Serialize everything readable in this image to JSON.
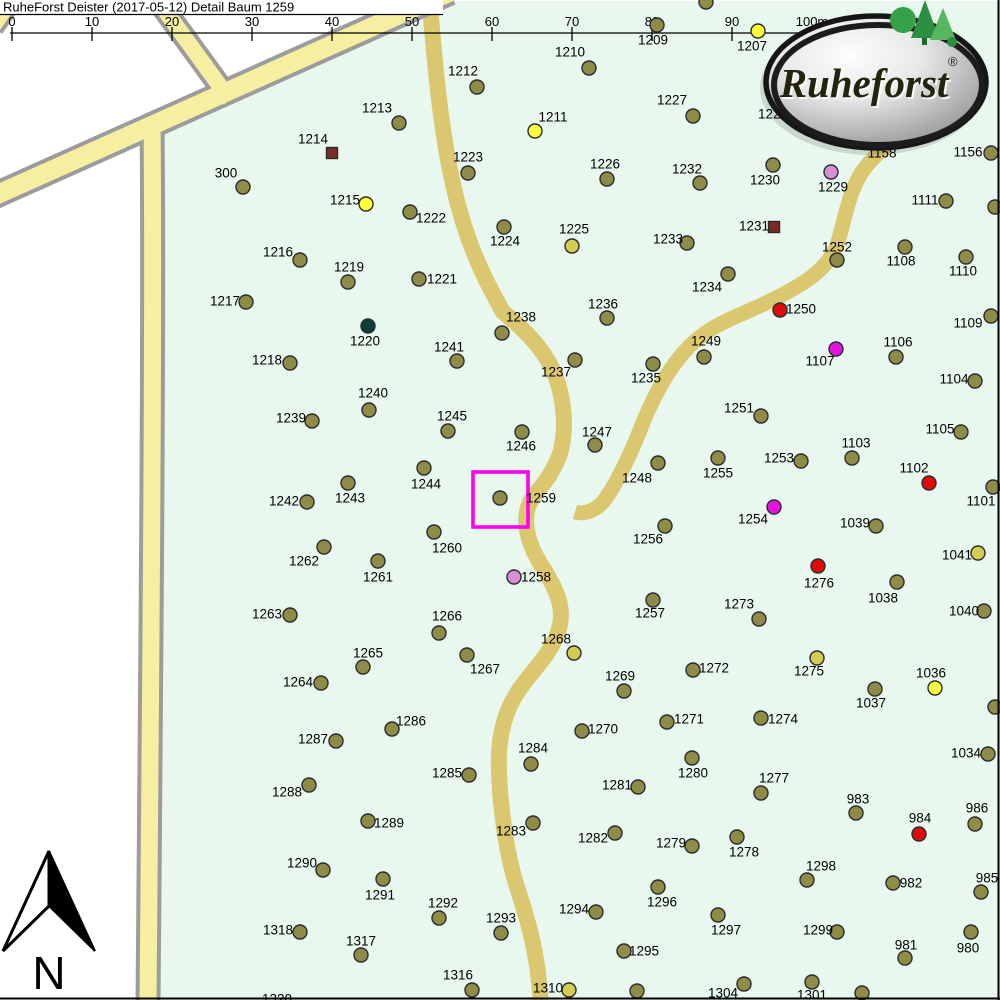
{
  "title": "RuheForst Deister (2017-05-12) Detail  Baum 1259",
  "scale_bar": {
    "labels": [
      "0",
      "10",
      "20",
      "30",
      "40",
      "50",
      "60",
      "70",
      "80",
      "90",
      "100m"
    ]
  },
  "north_label": "N",
  "logo": {
    "text": "Ruheforst",
    "reg": "®"
  },
  "highlight": {
    "tree_id": "1259",
    "x": 473,
    "y": 472,
    "size": 55,
    "color": "#FF00F2"
  },
  "colors": {
    "olive": "#8F8C48",
    "yellow": "#FFFF3C",
    "ygreen": "#D4CC52",
    "red": "#DE0D0D",
    "magenta": "#E513DF",
    "orchid": "#D98FD5",
    "teal": "#0F3D3B",
    "brown": "#7E2B26",
    "road_yellow": "#F6EFA2",
    "road_casing": "#9C9C9C",
    "road_tan": "#DCC771",
    "forest_green": "#E8F8EE"
  },
  "map": {
    "trees": [
      {
        "id": "300",
        "x": 243,
        "y": 187,
        "lx": 226,
        "ly": 173
      },
      {
        "id": "1207",
        "x": 758,
        "y": 31,
        "lx": 752,
        "ly": 46,
        "c": "yellow"
      },
      {
        "id": "1209",
        "x": 657,
        "y": 25,
        "lx": 653,
        "ly": 40
      },
      {
        "id": "",
        "x": 706,
        "y": 2
      },
      {
        "id": "1210",
        "x": 589,
        "y": 68,
        "lx": 570,
        "ly": 52
      },
      {
        "id": "1211",
        "x": 535,
        "y": 131,
        "lx": 553,
        "ly": 117,
        "c": "yellow"
      },
      {
        "id": "1212",
        "x": 477,
        "y": 87,
        "lx": 463,
        "ly": 71
      },
      {
        "id": "1213",
        "x": 399,
        "y": 123,
        "lx": 377,
        "ly": 108
      },
      {
        "id": "1214",
        "x": 332,
        "y": 153,
        "lx": 313,
        "ly": 139,
        "c": "brown",
        "shape": "sq"
      },
      {
        "id": "1215",
        "x": 366,
        "y": 204,
        "lx": 345,
        "ly": 200,
        "c": "yellow"
      },
      {
        "id": "1216",
        "x": 300,
        "y": 260,
        "lx": 278,
        "ly": 252
      },
      {
        "id": "1217",
        "x": 246,
        "y": 302,
        "lx": 225,
        "ly": 301
      },
      {
        "id": "1218",
        "x": 290,
        "y": 363,
        "lx": 267,
        "ly": 360
      },
      {
        "id": "1219",
        "x": 348,
        "y": 282,
        "lx": 349,
        "ly": 267
      },
      {
        "id": "1220",
        "x": 368,
        "y": 326,
        "lx": 365,
        "ly": 341,
        "c": "teal"
      },
      {
        "id": "1221",
        "x": 419,
        "y": 279,
        "lx": 442,
        "ly": 279
      },
      {
        "id": "1222",
        "x": 410,
        "y": 212,
        "lx": 431,
        "ly": 218
      },
      {
        "id": "1223",
        "x": 468,
        "y": 173,
        "lx": 468,
        "ly": 157
      },
      {
        "id": "1224",
        "x": 504,
        "y": 227,
        "lx": 505,
        "ly": 241
      },
      {
        "id": "1225",
        "x": 572,
        "y": 246,
        "lx": 574,
        "ly": 229,
        "c": "ygreen"
      },
      {
        "id": "1226",
        "x": 607,
        "y": 179,
        "lx": 605,
        "ly": 164
      },
      {
        "id": "1227",
        "x": 693,
        "y": 116,
        "lx": 672,
        "ly": 100
      },
      {
        "id": "1228",
        "lx": 773,
        "ly": 114
      },
      {
        "id": "1229",
        "x": 831,
        "y": 172,
        "lx": 833,
        "ly": 187,
        "c": "orchid"
      },
      {
        "id": "1230",
        "x": 773,
        "y": 165,
        "lx": 765,
        "ly": 180
      },
      {
        "id": "1231",
        "x": 774,
        "y": 227,
        "lx": 754,
        "ly": 226,
        "c": "brown",
        "shape": "sq"
      },
      {
        "id": "1232",
        "x": 700,
        "y": 183,
        "lx": 687,
        "ly": 169
      },
      {
        "id": "1233",
        "x": 687,
        "y": 243,
        "lx": 668,
        "ly": 239
      },
      {
        "id": "1234",
        "x": 728,
        "y": 274,
        "lx": 707,
        "ly": 287
      },
      {
        "id": "1235",
        "x": 653,
        "y": 364,
        "lx": 646,
        "ly": 378
      },
      {
        "id": "1236",
        "x": 607,
        "y": 318,
        "lx": 603,
        "ly": 304
      },
      {
        "id": "1237",
        "x": 575,
        "y": 360,
        "lx": 556,
        "ly": 372
      },
      {
        "id": "1238",
        "x": 502,
        "y": 333,
        "lx": 521,
        "ly": 317
      },
      {
        "id": "1239",
        "x": 312,
        "y": 421,
        "lx": 291,
        "ly": 418
      },
      {
        "id": "1240",
        "x": 369,
        "y": 410,
        "lx": 373,
        "ly": 393
      },
      {
        "id": "1241",
        "x": 457,
        "y": 361,
        "lx": 449,
        "ly": 347
      },
      {
        "id": "1242",
        "x": 307,
        "y": 502,
        "lx": 284,
        "ly": 501
      },
      {
        "id": "1243",
        "x": 348,
        "y": 483,
        "lx": 350,
        "ly": 498
      },
      {
        "id": "1244",
        "x": 424,
        "y": 468,
        "lx": 426,
        "ly": 484
      },
      {
        "id": "1245",
        "x": 448,
        "y": 431,
        "lx": 452,
        "ly": 416
      },
      {
        "id": "1246",
        "x": 522,
        "y": 432,
        "lx": 521,
        "ly": 446
      },
      {
        "id": "1247",
        "x": 595,
        "y": 445,
        "lx": 597,
        "ly": 432
      },
      {
        "id": "1248",
        "x": 658,
        "y": 463,
        "lx": 637,
        "ly": 478
      },
      {
        "id": "1249",
        "x": 704,
        "y": 357,
        "lx": 706,
        "ly": 341
      },
      {
        "id": "1250",
        "x": 780,
        "y": 310,
        "lx": 801,
        "ly": 309,
        "c": "red"
      },
      {
        "id": "1251",
        "x": 761,
        "y": 416,
        "lx": 739,
        "ly": 408
      },
      {
        "id": "1252",
        "x": 837,
        "y": 260,
        "lx": 837,
        "ly": 247
      },
      {
        "id": "1253",
        "x": 801,
        "y": 461,
        "lx": 779,
        "ly": 458
      },
      {
        "id": "1254",
        "x": 774,
        "y": 507,
        "lx": 753,
        "ly": 519,
        "c": "magenta"
      },
      {
        "id": "1255",
        "x": 718,
        "y": 458,
        "lx": 718,
        "ly": 473
      },
      {
        "id": "1256",
        "x": 665,
        "y": 526,
        "lx": 648,
        "ly": 539
      },
      {
        "id": "1257",
        "x": 653,
        "y": 600,
        "lx": 650,
        "ly": 613
      },
      {
        "id": "1258",
        "x": 514,
        "y": 577,
        "lx": 536,
        "ly": 577,
        "c": "orchid"
      },
      {
        "id": "1259",
        "x": 500,
        "y": 498,
        "lx": 541,
        "ly": 498
      },
      {
        "id": "1260",
        "x": 434,
        "y": 532,
        "lx": 447,
        "ly": 548
      },
      {
        "id": "1261",
        "x": 378,
        "y": 561,
        "lx": 378,
        "ly": 577
      },
      {
        "id": "1262",
        "x": 324,
        "y": 547,
        "lx": 304,
        "ly": 561
      },
      {
        "id": "1263",
        "x": 290,
        "y": 615,
        "lx": 267,
        "ly": 614
      },
      {
        "id": "1264",
        "x": 321,
        "y": 683,
        "lx": 298,
        "ly": 682
      },
      {
        "id": "1265",
        "x": 363,
        "y": 667,
        "lx": 368,
        "ly": 653
      },
      {
        "id": "1266",
        "x": 439,
        "y": 633,
        "lx": 447,
        "ly": 616
      },
      {
        "id": "1267",
        "x": 467,
        "y": 655,
        "lx": 485,
        "ly": 669
      },
      {
        "id": "1268",
        "x": 574,
        "y": 653,
        "lx": 556,
        "ly": 639,
        "c": "ygreen"
      },
      {
        "id": "1269",
        "x": 624,
        "y": 691,
        "lx": 620,
        "ly": 676
      },
      {
        "id": "1270",
        "x": 582,
        "y": 731,
        "lx": 603,
        "ly": 729
      },
      {
        "id": "1271",
        "x": 667,
        "y": 722,
        "lx": 689,
        "ly": 719
      },
      {
        "id": "1272",
        "x": 693,
        "y": 670,
        "lx": 714,
        "ly": 668
      },
      {
        "id": "1273",
        "x": 759,
        "y": 619,
        "lx": 739,
        "ly": 604
      },
      {
        "id": "1274",
        "x": 761,
        "y": 718,
        "lx": 783,
        "ly": 719
      },
      {
        "id": "1275",
        "x": 817,
        "y": 658,
        "lx": 809,
        "ly": 671,
        "c": "ygreen"
      },
      {
        "id": "1276",
        "x": 818,
        "y": 566,
        "lx": 819,
        "ly": 583,
        "c": "red"
      },
      {
        "id": "1277",
        "x": 761,
        "y": 793,
        "lx": 774,
        "ly": 778
      },
      {
        "id": "1278",
        "x": 737,
        "y": 837,
        "lx": 744,
        "ly": 852
      },
      {
        "id": "1279",
        "x": 692,
        "y": 846,
        "lx": 671,
        "ly": 843
      },
      {
        "id": "1280",
        "x": 692,
        "y": 758,
        "lx": 693,
        "ly": 773
      },
      {
        "id": "1281",
        "x": 638,
        "y": 787,
        "lx": 617,
        "ly": 785
      },
      {
        "id": "1282",
        "x": 615,
        "y": 833,
        "lx": 593,
        "ly": 838
      },
      {
        "id": "1283",
        "x": 533,
        "y": 823,
        "lx": 511,
        "ly": 831
      },
      {
        "id": "1284",
        "x": 531,
        "y": 764,
        "lx": 533,
        "ly": 748
      },
      {
        "id": "1285",
        "x": 469,
        "y": 775,
        "lx": 447,
        "ly": 773
      },
      {
        "id": "1286",
        "x": 392,
        "y": 729,
        "lx": 411,
        "ly": 721
      },
      {
        "id": "1287",
        "x": 336,
        "y": 741,
        "lx": 313,
        "ly": 739
      },
      {
        "id": "1288",
        "x": 309,
        "y": 785,
        "lx": 287,
        "ly": 792
      },
      {
        "id": "1289",
        "x": 368,
        "y": 821,
        "lx": 389,
        "ly": 823
      },
      {
        "id": "1290",
        "x": 323,
        "y": 870,
        "lx": 302,
        "ly": 863
      },
      {
        "id": "1291",
        "x": 383,
        "y": 879,
        "lx": 380,
        "ly": 895
      },
      {
        "id": "1292",
        "x": 439,
        "y": 918,
        "lx": 443,
        "ly": 903
      },
      {
        "id": "1293",
        "x": 501,
        "y": 933,
        "lx": 501,
        "ly": 918
      },
      {
        "id": "1294",
        "x": 596,
        "y": 912,
        "lx": 574,
        "ly": 909
      },
      {
        "id": "1295",
        "x": 624,
        "y": 951,
        "lx": 644,
        "ly": 951
      },
      {
        "id": "1296",
        "x": 658,
        "y": 887,
        "lx": 662,
        "ly": 902
      },
      {
        "id": "1297",
        "x": 718,
        "y": 915,
        "lx": 726,
        "ly": 930
      },
      {
        "id": "1298",
        "x": 807,
        "y": 880,
        "lx": 821,
        "ly": 866
      },
      {
        "id": "1299",
        "x": 837,
        "y": 932,
        "lx": 818,
        "ly": 930
      },
      {
        "id": "1301",
        "x": 812,
        "y": 982,
        "lx": 812,
        "ly": 995
      },
      {
        "id": "1304",
        "x": 744,
        "y": 984,
        "lx": 723,
        "ly": 993
      },
      {
        "id": "1310",
        "x": 569,
        "y": 990,
        "lx": 548,
        "ly": 988,
        "c": "ygreen"
      },
      {
        "id": "1316",
        "x": 472,
        "y": 990,
        "lx": 458,
        "ly": 975
      },
      {
        "id": "1317",
        "x": 361,
        "y": 955,
        "lx": 361,
        "ly": 941
      },
      {
        "id": "1318",
        "x": 300,
        "y": 932,
        "lx": 278,
        "ly": 930
      },
      {
        "id": "1320",
        "lx": 277,
        "ly": 999
      },
      {
        "id": "",
        "x": 637,
        "y": 991
      },
      {
        "id": "",
        "x": 862,
        "y": 993
      },
      {
        "id": "980",
        "x": 971,
        "y": 932,
        "lx": 968,
        "ly": 948
      },
      {
        "id": "981",
        "x": 905,
        "y": 958,
        "lx": 906,
        "ly": 945
      },
      {
        "id": "982",
        "x": 893,
        "y": 883,
        "lx": 911,
        "ly": 883
      },
      {
        "id": "983",
        "x": 856,
        "y": 813,
        "lx": 858,
        "ly": 799
      },
      {
        "id": "984",
        "x": 919,
        "y": 834,
        "lx": 920,
        "ly": 818,
        "c": "red"
      },
      {
        "id": "985",
        "x": 981,
        "y": 892,
        "lx": 987,
        "ly": 878
      },
      {
        "id": "986",
        "x": 975,
        "y": 824,
        "lx": 977,
        "ly": 808
      },
      {
        "id": "1034",
        "x": 988,
        "y": 754,
        "lx": 966,
        "ly": 753
      },
      {
        "id": "",
        "x": 995,
        "y": 707
      },
      {
        "id": "1036",
        "x": 935,
        "y": 688,
        "lx": 931,
        "ly": 673,
        "c": "yellow"
      },
      {
        "id": "1037",
        "x": 875,
        "y": 689,
        "lx": 871,
        "ly": 703
      },
      {
        "id": "1038",
        "x": 897,
        "y": 582,
        "lx": 883,
        "ly": 598
      },
      {
        "id": "1039",
        "x": 876,
        "y": 526,
        "lx": 855,
        "ly": 523
      },
      {
        "id": "1040",
        "x": 984,
        "y": 611,
        "lx": 964,
        "ly": 611
      },
      {
        "id": "1041",
        "x": 978,
        "y": 553,
        "lx": 957,
        "ly": 555,
        "c": "ygreen"
      },
      {
        "id": "1101",
        "x": 993,
        "y": 487,
        "lx": 981,
        "ly": 501
      },
      {
        "id": "1102",
        "x": 929,
        "y": 483,
        "lx": 914,
        "ly": 468,
        "c": "red"
      },
      {
        "id": "1103",
        "x": 852,
        "y": 458,
        "lx": 856,
        "ly": 443
      },
      {
        "id": "1104",
        "x": 975,
        "y": 381,
        "lx": 954,
        "ly": 379
      },
      {
        "id": "1105",
        "x": 961,
        "y": 432,
        "lx": 940,
        "ly": 429
      },
      {
        "id": "1106",
        "x": 896,
        "y": 357,
        "lx": 898,
        "ly": 342
      },
      {
        "id": "1107",
        "x": 836,
        "y": 349,
        "lx": 820,
        "ly": 361,
        "c": "magenta"
      },
      {
        "id": "1108",
        "x": 905,
        "y": 247,
        "lx": 901,
        "ly": 261
      },
      {
        "id": "1109",
        "x": 991,
        "y": 316,
        "lx": 968,
        "ly": 323
      },
      {
        "id": "1110",
        "x": 966,
        "y": 257,
        "lx": 963,
        "ly": 271
      },
      {
        "id": "1111",
        "x": 946,
        "y": 201,
        "lx": 925,
        "ly": 200
      },
      {
        "id": "1156",
        "x": 991,
        "y": 153,
        "lx": 968,
        "ly": 152
      },
      {
        "id": "1158",
        "lx": 882,
        "ly": 153
      },
      {
        "id": "",
        "x": 995,
        "y": 207
      }
    ]
  }
}
